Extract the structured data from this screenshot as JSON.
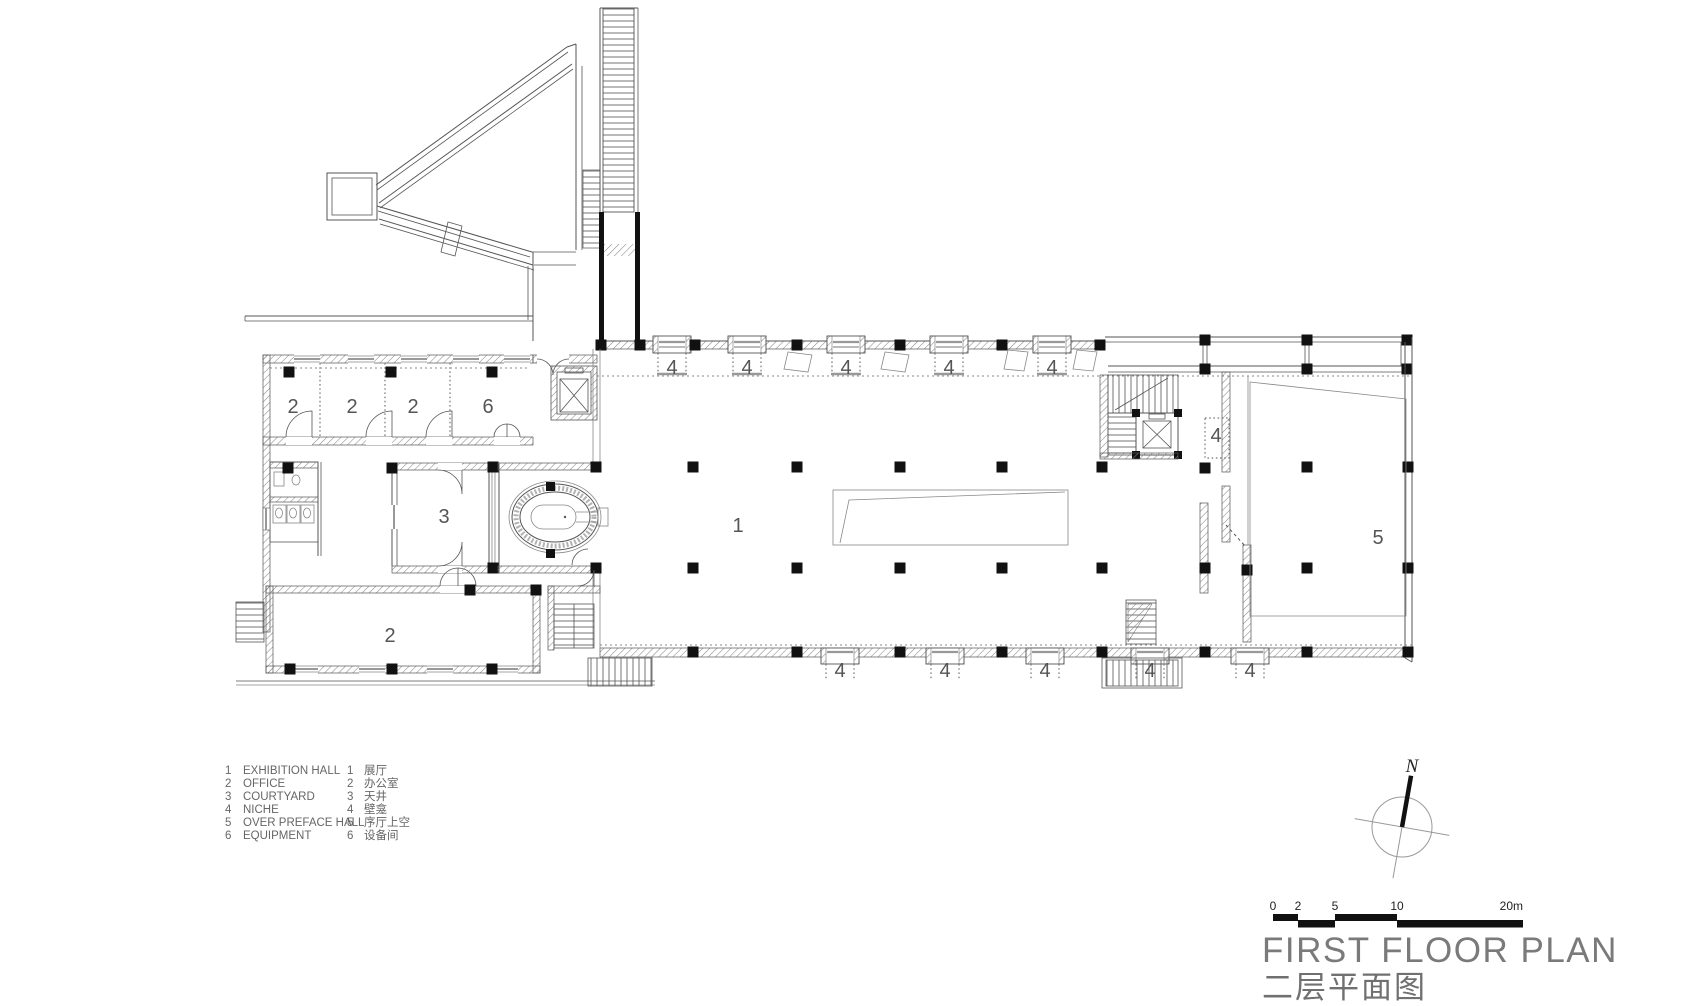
{
  "title": {
    "en": "FIRST FLOOR PLAN",
    "zh": "二层平面图"
  },
  "north_indicator": {
    "label": "N"
  },
  "scale_bar": {
    "ticks": [
      {
        "label": "0",
        "x": 1273
      },
      {
        "label": "2",
        "x": 1298
      },
      {
        "label": "5",
        "x": 1335
      },
      {
        "label": "10",
        "x": 1397
      },
      {
        "label": "20m",
        "x": 1523
      }
    ]
  },
  "legend": {
    "en": [
      {
        "num": "1",
        "label": "EXHIBITION HALL"
      },
      {
        "num": "2",
        "label": "OFFICE"
      },
      {
        "num": "3",
        "label": "COURTYARD"
      },
      {
        "num": "4",
        "label": "NICHE"
      },
      {
        "num": "5",
        "label": "OVER PREFACE HALL"
      },
      {
        "num": "6",
        "label": "EQUIPMENT"
      }
    ],
    "zh": [
      {
        "num": "1",
        "label": "展厅"
      },
      {
        "num": "2",
        "label": "办公室"
      },
      {
        "num": "3",
        "label": "天井"
      },
      {
        "num": "4",
        "label": "壁龛"
      },
      {
        "num": "5",
        "label": "序厅上空"
      },
      {
        "num": "6",
        "label": "设备间"
      }
    ]
  },
  "plan": {
    "room_labels": [
      {
        "t": "2",
        "x": 293,
        "y": 407
      },
      {
        "t": "2",
        "x": 352,
        "y": 407
      },
      {
        "t": "2",
        "x": 413,
        "y": 407
      },
      {
        "t": "6",
        "x": 488,
        "y": 407
      },
      {
        "t": "4",
        "x": 672,
        "y": 368
      },
      {
        "t": "4",
        "x": 747,
        "y": 368
      },
      {
        "t": "4",
        "x": 846,
        "y": 368
      },
      {
        "t": "4",
        "x": 949,
        "y": 368
      },
      {
        "t": "4",
        "x": 1052,
        "y": 368
      },
      {
        "t": "3",
        "x": 444,
        "y": 517
      },
      {
        "t": "1",
        "x": 738,
        "y": 526
      },
      {
        "t": "4",
        "x": 1216,
        "y": 436
      },
      {
        "t": "5",
        "x": 1378,
        "y": 538
      },
      {
        "t": "2",
        "x": 390,
        "y": 636
      },
      {
        "t": "4",
        "x": 840,
        "y": 671
      },
      {
        "t": "4",
        "x": 945,
        "y": 671
      },
      {
        "t": "4",
        "x": 1045,
        "y": 671
      },
      {
        "t": "4",
        "x": 1150,
        "y": 671
      },
      {
        "t": "4",
        "x": 1250,
        "y": 671
      }
    ]
  },
  "colors": {
    "wall": "#555",
    "column": "#111",
    "label": "#555",
    "sill": "#999",
    "title": "#7a7a7a"
  }
}
